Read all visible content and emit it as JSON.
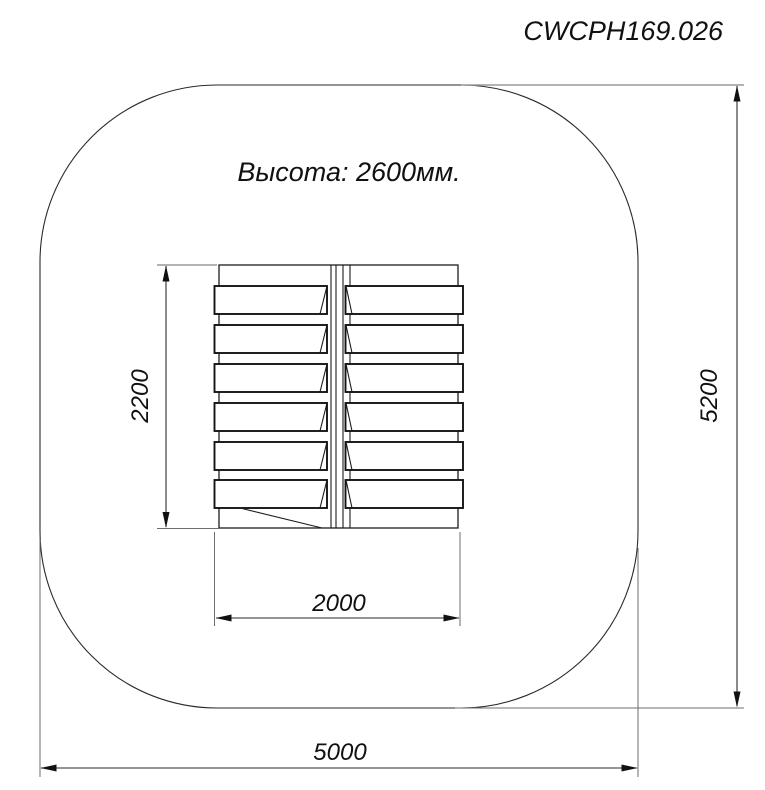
{
  "drawing": {
    "code": "CWCPH169.026",
    "height_note": "Высота: 2600мм.",
    "dims": {
      "equipment_width": "2000",
      "equipment_depth": "2200",
      "zone_width": "5000",
      "zone_depth": "5200"
    }
  }
}
